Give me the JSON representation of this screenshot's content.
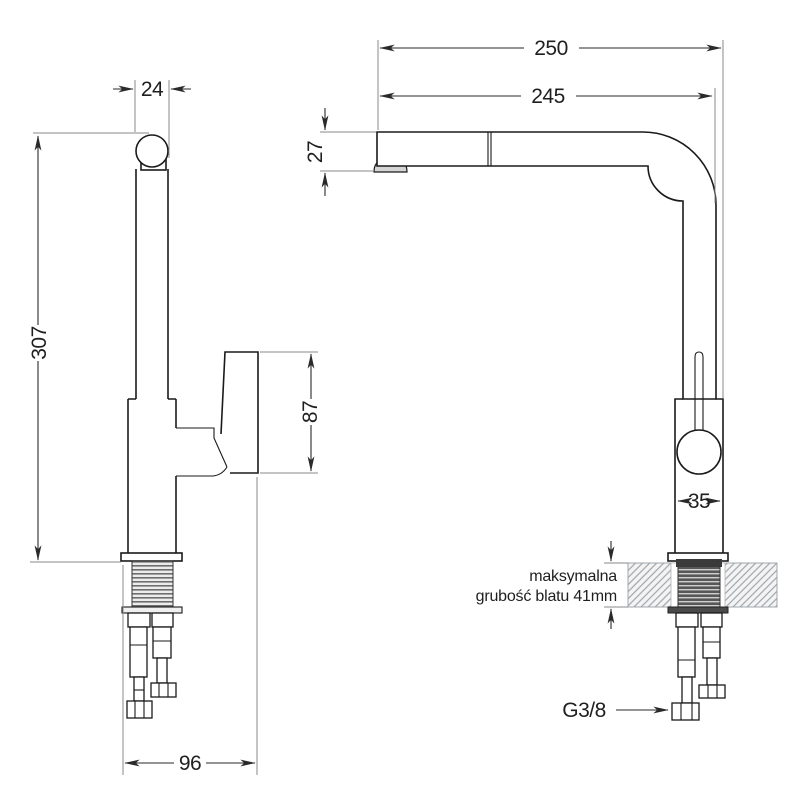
{
  "drawing_type": "kitchen faucet technical dimension drawing, two orthographic views",
  "dimensions": {
    "spout_diameter": "24",
    "total_reach": "250",
    "spout_reach": "245",
    "spout_head_height": "27",
    "total_height": "307",
    "handle_height": "87",
    "body_diameter": "35",
    "base_depth": "96",
    "hose_thread": "G3/8",
    "counter_note_line1": "maksymalna",
    "counter_note_line2": "grubość blatu 41mm"
  },
  "colors": {
    "line": "#1a1a1a",
    "dimension": "#2a2a2a",
    "extension": "#8a8a8a",
    "hatch": "#9fa6ab",
    "thread_dark": "#585858",
    "thread_light": "#6e6e6e",
    "metal_shade": "#d4d4d4",
    "background": "#ffffff"
  }
}
